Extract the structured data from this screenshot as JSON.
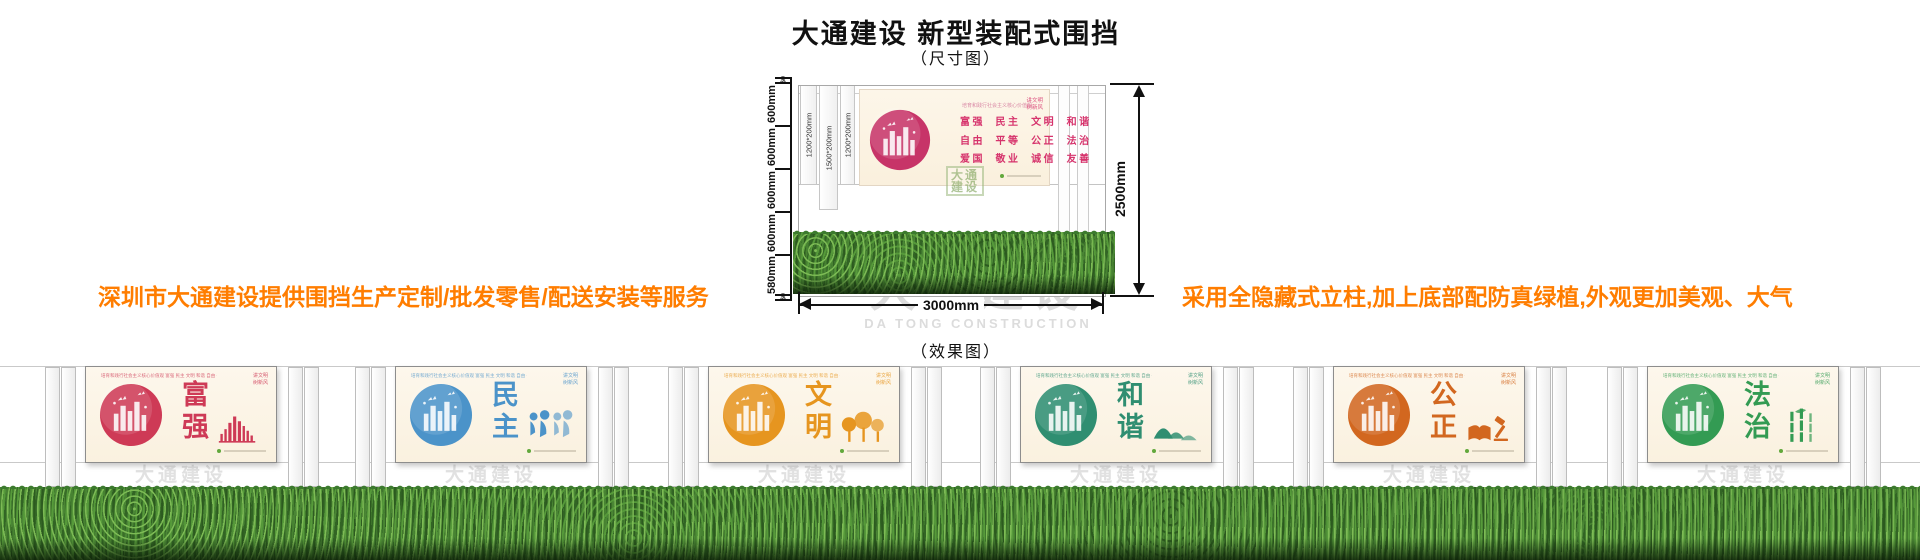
{
  "page": {
    "title": "大通建设 新型装配式围挡",
    "dimension_label": "（尺寸图）",
    "effect_label": "（效果图）"
  },
  "notes": {
    "left": "深圳市大通建设提供围挡生产定制/批发零售/配送安装等服务",
    "right": "采用全隐藏式立柱,加上底部配防真绿植,外观更加美观、大气",
    "color": "#ff7d00"
  },
  "watermark": {
    "cn": "大通建设",
    "en": "DA TONG CONSTRUCTION"
  },
  "diagram": {
    "left_ruler": {
      "top_small": "60",
      "segments": [
        "600mm",
        "600mm",
        "600mm",
        "600mm",
        "580mm"
      ],
      "bottom_small": "60"
    },
    "height_dim": "2500mm",
    "width_dim": "3000mm",
    "post_labels": [
      "1200*200mm",
      "1500*200mm",
      "1200*200mm"
    ],
    "board": {
      "slogan": "培育和践行社会主义核心价值观",
      "corner_line1": "讲文明",
      "corner_line2": "树新风",
      "rows": [
        "富强  民主  文明  和谐",
        "自由  平等  公正  法治",
        "爱国  敬业  诚信  友善"
      ],
      "logo_line1": "大通",
      "logo_line2": "建设",
      "accent": "#d6336c"
    }
  },
  "effect": {
    "header": "培育和践行社会主义核心价值观  富强 民主 文明 和谐 自由 平等 公正 法治 爱国 敬业 诚信 友善",
    "corner_line1": "讲文明",
    "corner_line2": "树新风",
    "panels": [
      {
        "title": "富强",
        "color": "#ce3a56",
        "motif": "skyline"
      },
      {
        "title": "民主",
        "color": "#4b93c9",
        "motif": "figures"
      },
      {
        "title": "文明",
        "color": "#e6951f",
        "motif": "trees"
      },
      {
        "title": "和谐",
        "color": "#2f8e71",
        "motif": "mountains"
      },
      {
        "title": "公正",
        "color": "#d2671f",
        "motif": "book-gavel"
      },
      {
        "title": "法治",
        "color": "#339b53",
        "motif": "bamboo"
      }
    ],
    "grass_color": "#39742b"
  }
}
